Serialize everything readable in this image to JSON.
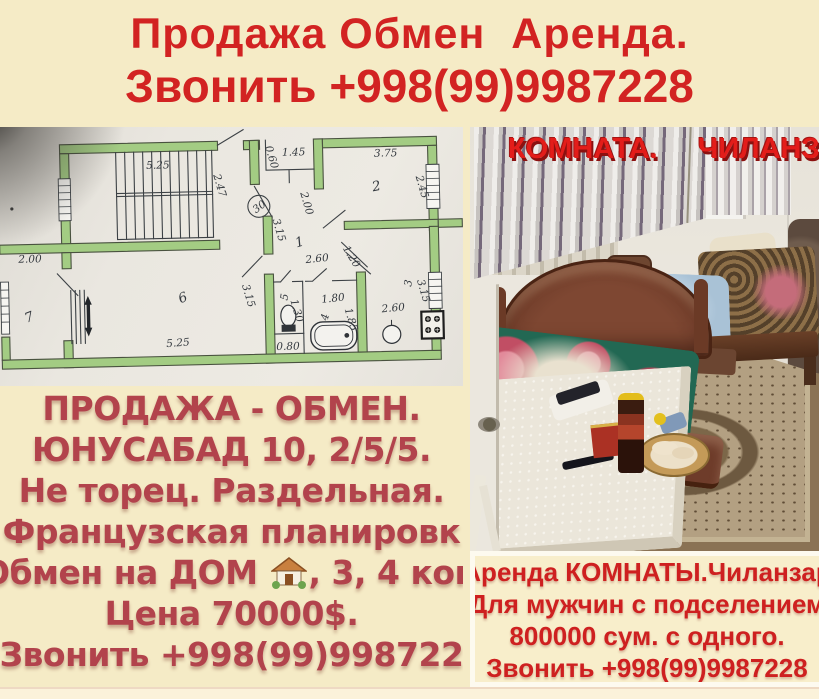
{
  "header": {
    "line1": "Продажа Обмен  Аренда.",
    "line2": "Звонить +998(99)9987228"
  },
  "left_panel": {
    "floorplan": {
      "stairs_len": "5.25",
      "stairs_dep": "2.47",
      "niche_w": "1.45",
      "niche_d": "0.60",
      "niche_h": "2.00",
      "circle": "30",
      "room2": "2",
      "room2_w": "3.75",
      "room2_d": "2.45",
      "hall": "1",
      "hall_d": "3.15",
      "hall_w": "2.60",
      "hall_diag": "1.20",
      "left_dim": "2.00",
      "room7": "7",
      "room6": "6",
      "room6_d": "3.15",
      "room6_w": "5.25",
      "wc": "5",
      "wc_d": "1.30",
      "wc_w": "0.80",
      "bath": "4",
      "bath_w": "1.80",
      "bath_d": "1.85",
      "kitchen": "3",
      "kitchen_w": "2.60",
      "kitchen_d": "3.15"
    },
    "ad": {
      "l1": "ПРОДАЖА - ОБМЕН.",
      "l2": "ЮНУСАБАД 10, 2/5/5.",
      "l3": "Не торец. Раздельная.",
      "l4": "Французская планировк",
      "l5a": "Обмен на ДОМ ",
      "l5b": ", 3, 4 ком",
      "l6": "Цена 70000$.",
      "l7": "Звонить +998(99)998722"
    }
  },
  "right_panel": {
    "photo_caption": {
      "part1": "КОМНАТА.",
      "part2": "ЧИЛАНЗА"
    },
    "ad": {
      "l1": "Аренда КОМНАТЫ.Чиланзар",
      "l2": "Для мужчин с подселением",
      "l3": "800000 сум. с одного.",
      "l4": "Звонить +998(99)9987228"
    }
  },
  "colors": {
    "background_cream": "#f5ebc6",
    "banner_red": "#d22322",
    "left_text_red": "#b2434c",
    "right_text_red": "#ce2020",
    "plan_wall_green": "#a3cc83"
  }
}
